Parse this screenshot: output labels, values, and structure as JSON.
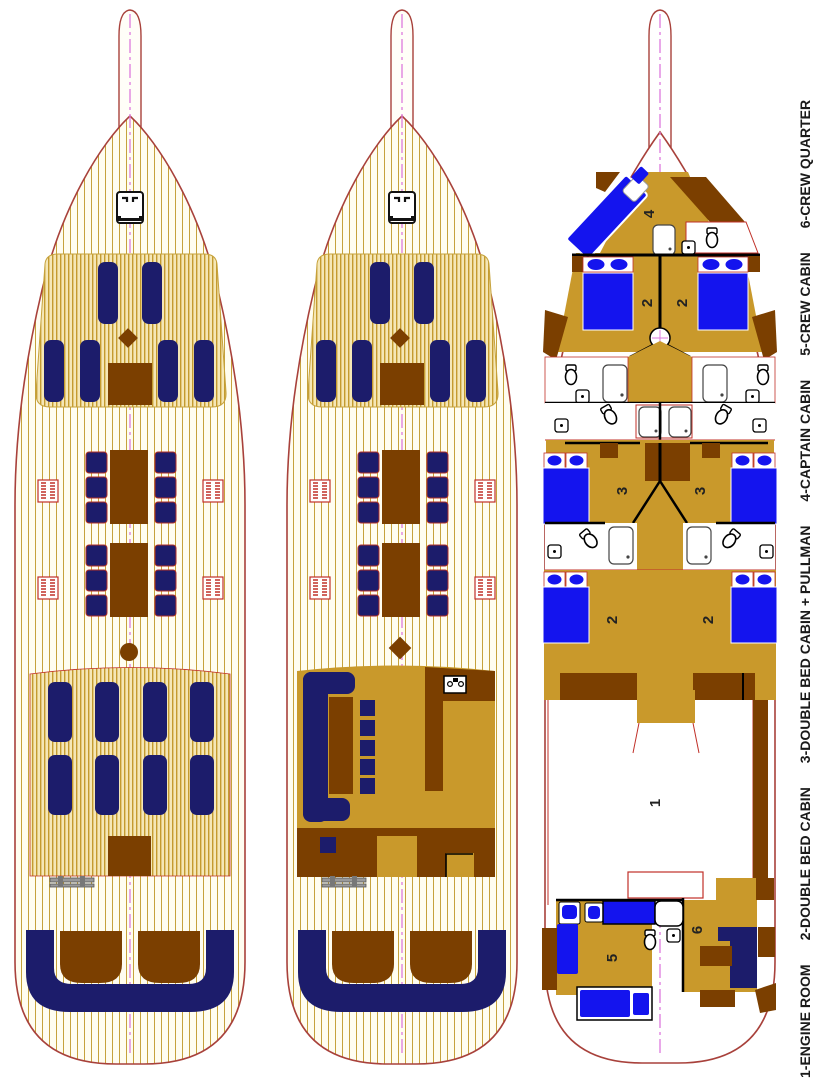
{
  "legend": {
    "items": [
      "1-ENGINE ROOM",
      "2-DOUBLE BED CABIN",
      "3-DOUBLE BED CABIN + PULLMAN",
      "4-CAPTAIN CABIN",
      "5-CREW CABIN",
      "6-CREW QUARTER"
    ]
  },
  "labels": {
    "engine_room": "1",
    "double_bed": "2",
    "double_bed_pullman": "3",
    "captain": "4",
    "crew_cabin": "5",
    "crew_quarter": "6"
  },
  "icons": {
    "windlass": "anchor-windlass",
    "toilet": "toilet",
    "shower": "shower-tray",
    "sink": "galley-sink",
    "gangway": "gangway-ladder",
    "mast": "mast-base"
  },
  "colors": {
    "hull_outline": "#A8413B",
    "plank_line": "#C6A23C",
    "deck_cream": "#FFFDF0",
    "pad_gold": "#F5E7B6",
    "cushion_navy": "#1C1C6B",
    "wood_brown": "#7B3F00",
    "floor_gold": "#C9992B",
    "bed_blue": "#1414EE",
    "accent_red": "#C03028",
    "centerline_magenta": "#DD7ADD",
    "wall_black": "#000000"
  }
}
